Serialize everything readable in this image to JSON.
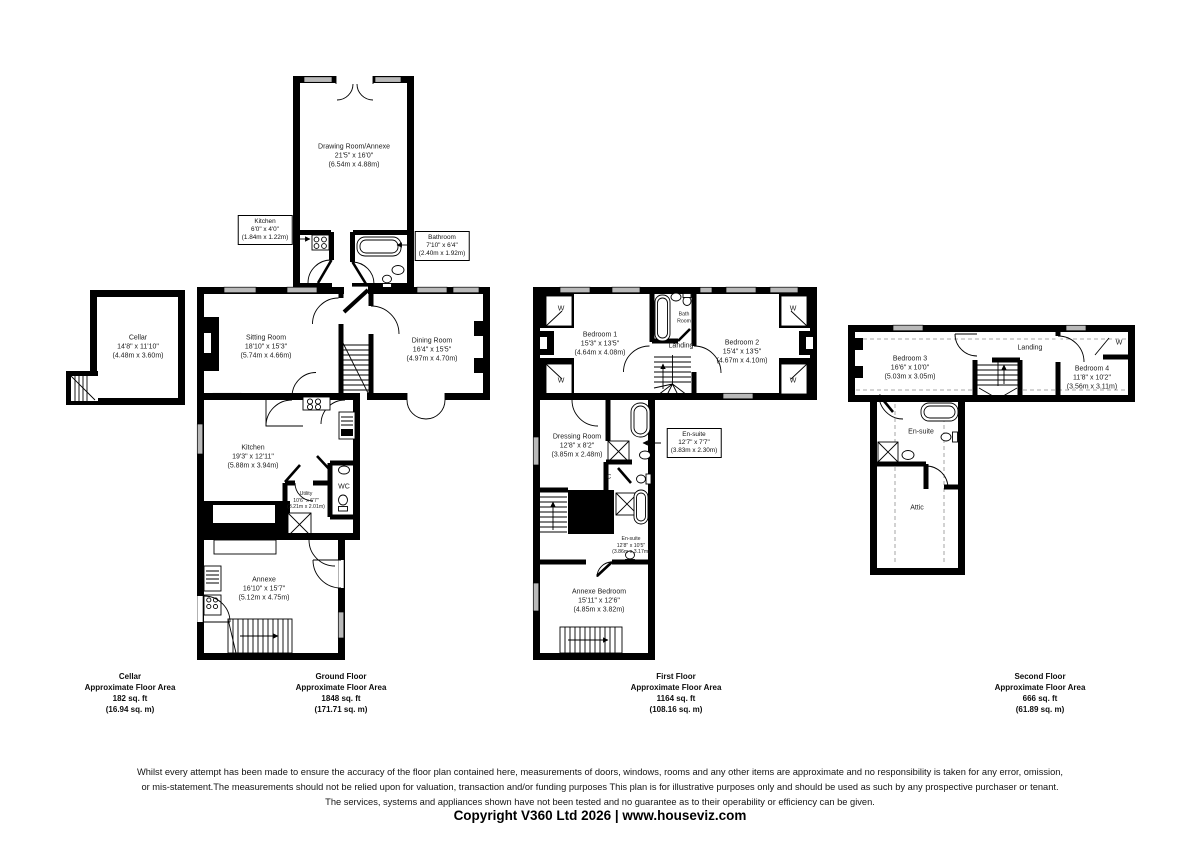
{
  "rooms": {
    "drawing_room": {
      "name": "Drawing Room/Annexe",
      "ft": "21'5\" x 16'0\"",
      "m": "(6.54m x 4.88m)"
    },
    "kitchen_small": {
      "name": "Kitchen",
      "ft": "6'0\" x 4'0\"",
      "m": "(1.84m x 1.22m)"
    },
    "bathroom": {
      "name": "Bathroom",
      "ft": "7'10\" x 6'4\"",
      "m": "(2.40m x 1.92m)"
    },
    "cellar": {
      "name": "Cellar",
      "ft": "14'8\" x 11'10\"",
      "m": "(4.48m x 3.60m)"
    },
    "sitting_room": {
      "name": "Sitting Room",
      "ft": "18'10\" x 15'3\"",
      "m": "(5.74m x 4.66m)"
    },
    "dining_room": {
      "name": "Dining Room",
      "ft": "16'4\" x 15'5\"",
      "m": "(4.97m x 4.70m)"
    },
    "kitchen": {
      "name": "Kitchen",
      "ft": "19'3\" x 12'11\"",
      "m": "(5.88m x 3.94m)"
    },
    "utility": {
      "name": "Utility",
      "ft": "10'6\" x 6'7\"",
      "m": "(3.21m x 2.01m)"
    },
    "wc": {
      "name": "WC"
    },
    "annexe": {
      "name": "Annexe",
      "ft": "16'10\" x 15'7\"",
      "m": "(5.12m x 4.75m)"
    },
    "bedroom1": {
      "name": "Bedroom 1",
      "ft": "15'3\" x 13'5\"",
      "m": "(4.64m x 4.08m)"
    },
    "bath_room": {
      "name": "Bath Room"
    },
    "landing1": {
      "name": "Landing"
    },
    "bedroom2": {
      "name": "Bedroom 2",
      "ft": "15'4\" x 13'5\"",
      "m": "(4.67m x 4.10m)"
    },
    "dressing_room": {
      "name": "Dressing Room",
      "ft": "12'8\" x 8'2\"",
      "m": "(3.85m x 2.48m)"
    },
    "ensuite1": {
      "name": "En-suite",
      "ft": "12'7\" x 7'7\"",
      "m": "(3.83m x 2.30m)"
    },
    "cupboard": {
      "label": "C"
    },
    "ensuite2": {
      "name": "En-suite",
      "ft": "12'8\" x 10'5\"",
      "m": "(3.86m x 3.17m)"
    },
    "annexe_bedroom": {
      "name": "Annexe Bedroom",
      "ft": "15'11\" x 12'6\"",
      "m": "(4.85m x 3.82m)"
    },
    "bedroom3": {
      "name": "Bedroom 3",
      "ft": "16'6\" x 10'0\"",
      "m": "(5.03m x 3.05m)"
    },
    "landing2": {
      "name": "Landing"
    },
    "bedroom4": {
      "name": "Bedroom 4",
      "ft": "11'8\" x 10'2\"",
      "m": "(3.56m x 3.11m)"
    },
    "ensuite3": {
      "name": "En-suite"
    },
    "attic": {
      "name": "Attic"
    },
    "wardrobe": {
      "label": "W"
    }
  },
  "floors": {
    "cellar": {
      "name": "Cellar",
      "area_label": "Approximate Floor Area",
      "sqft": "182 sq. ft",
      "sqm": "(16.94 sq. m)"
    },
    "ground": {
      "name": "Ground Floor",
      "area_label": "Approximate Floor Area",
      "sqft": "1848 sq. ft",
      "sqm": "(171.71 sq. m)"
    },
    "first": {
      "name": "First Floor",
      "area_label": "Approximate Floor Area",
      "sqft": "1164 sq. ft",
      "sqm": "(108.16 sq. m)"
    },
    "second": {
      "name": "Second Floor",
      "area_label": "Approximate Floor Area",
      "sqft": "666 sq. ft",
      "sqm": "(61.89 sq. m)"
    }
  },
  "footer": {
    "disclaimer_line1": "Whilst every attempt has been made to ensure the accuracy of the floor plan contained here, measurements of doors, windows, rooms and any other items are approximate and no responsibility is taken for any error, omission,",
    "disclaimer_line2": "or mis-statement.The measurements should not be relied upon for valuation, transaction and/or funding purposes This plan is for illustrative purposes only and should be used as such by any prospective purchaser or tenant.",
    "disclaimer_line3": "The services, systems and appliances shown have not been tested and no guarantee as to their operability or efficiency can be given.",
    "copyright": "Copyright V360 Ltd 2026 | www.houseviz.com"
  },
  "colors": {
    "wall": "#000000",
    "window_fill": "#b9b9b9",
    "dashed_line": "#8e8e8e"
  }
}
